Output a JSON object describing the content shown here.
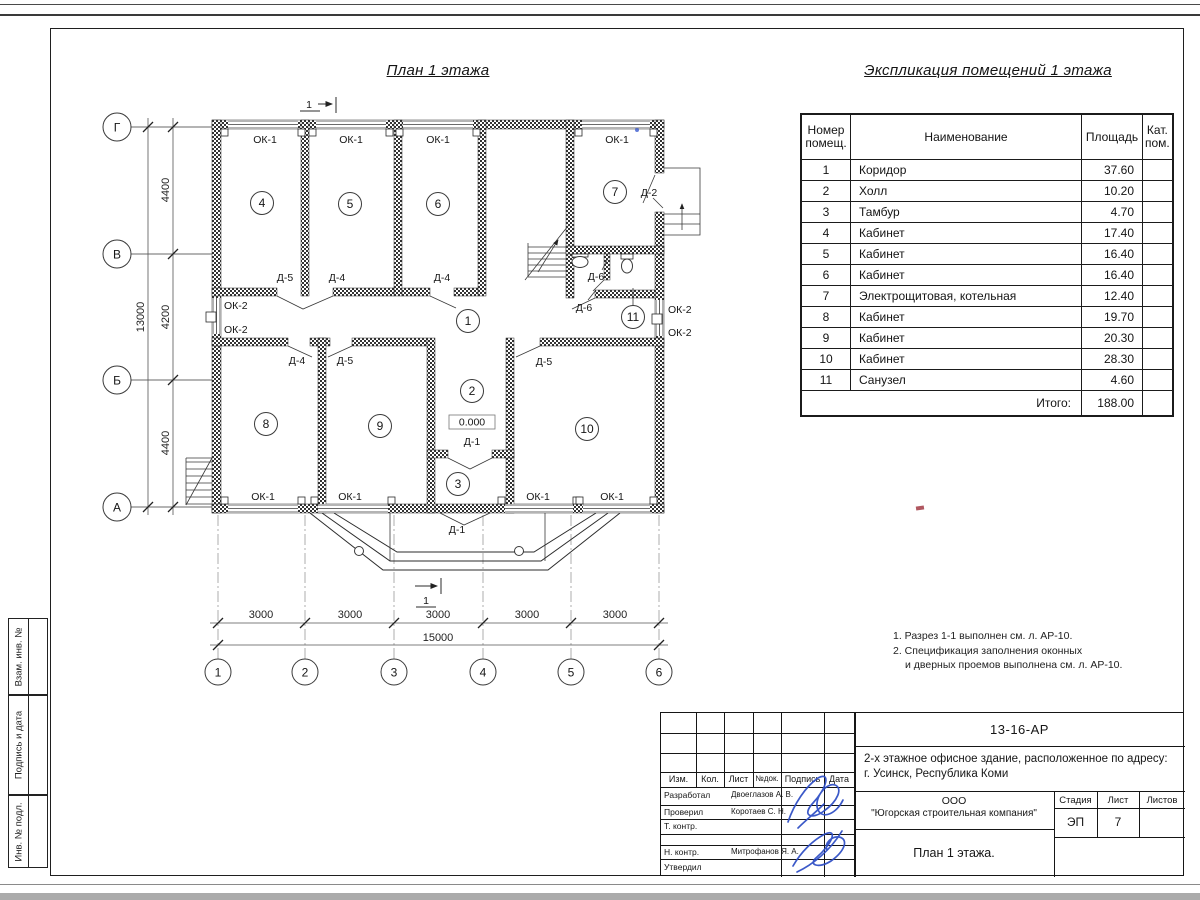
{
  "titles": {
    "plan": "План 1 этажа",
    "explication": "Экспликация помещений 1 этажа"
  },
  "explication": {
    "headers": {
      "number": "Номер",
      "number2": "помещ.",
      "name": "Наименование",
      "area": "Площадь",
      "cat": "Кат.",
      "cat2": "пом."
    },
    "rows": [
      {
        "num": "1",
        "name": "Коридор",
        "area": "37.60"
      },
      {
        "num": "2",
        "name": "Холл",
        "area": "10.20"
      },
      {
        "num": "3",
        "name": "Тамбур",
        "area": "4.70"
      },
      {
        "num": "4",
        "name": "Кабинет",
        "area": "17.40"
      },
      {
        "num": "5",
        "name": "Кабинет",
        "area": "16.40"
      },
      {
        "num": "6",
        "name": "Кабинет",
        "area": "16.40"
      },
      {
        "num": "7",
        "name": "Электрощитовая, котельная",
        "area": "12.40"
      },
      {
        "num": "8",
        "name": "Кабинет",
        "area": "19.70"
      },
      {
        "num": "9",
        "name": "Кабинет",
        "area": "20.30"
      },
      {
        "num": "10",
        "name": "Кабинет",
        "area": "28.30"
      },
      {
        "num": "11",
        "name": "Санузел",
        "area": "4.60"
      }
    ],
    "total_label": "Итого:",
    "total_value": "188.00"
  },
  "plan": {
    "labels": {
      "ok1": "ОК-1",
      "ok2": "ОК-2",
      "d1": "Д-1",
      "d2": "Д-2",
      "d4": "Д-4",
      "d5": "Д-5",
      "d6": "Д-6",
      "elevation": "0.000",
      "section": "1"
    },
    "rooms": [
      "1",
      "2",
      "3",
      "4",
      "5",
      "6",
      "7",
      "8",
      "9",
      "10",
      "11"
    ],
    "axes": {
      "vertical": [
        "Г",
        "В",
        "Б",
        "А"
      ],
      "horizontal": [
        "1",
        "2",
        "3",
        "4",
        "5",
        "6"
      ]
    },
    "dims": {
      "left": [
        "4400",
        "4200",
        "4400"
      ],
      "left_total": "13000",
      "bottom": [
        "3000",
        "3000",
        "3000",
        "3000",
        "3000"
      ],
      "bottom_total": "15000"
    }
  },
  "notes": [
    "1. Разрез 1-1 выполнен см. л. АР-10.",
    "2. Спецификация заполнения оконных",
    "и дверных проемов выполнена см. л. АР-10."
  ],
  "titleblock": {
    "doc_number": "13-16-АР",
    "object_line1": "2-х этажное офисное здание, расположенное по адресу:",
    "object_line2": "г. Усинск, Республика Коми",
    "columns": [
      "Изм.",
      "Кол.",
      "Лист",
      "№док.",
      "Подпись",
      "Дата"
    ],
    "roles": [
      {
        "role": "Разработал",
        "name": "Двоеглазов А. В."
      },
      {
        "role": "Проверил",
        "name": "Коротаев С. Н."
      },
      {
        "role": "Т. контр.",
        "name": ""
      },
      {
        "role": "Н. контр.",
        "name": "Митрофанов Я. А."
      },
      {
        "role": "Утвердил",
        "name": ""
      }
    ],
    "company_line1": "ООО",
    "company_line2": "\"Югорская строительная компания\"",
    "stage_label": "Стадия",
    "sheet_label": "Лист",
    "sheets_label": "Листов",
    "stage_value": "ЭП",
    "sheet_value": "7",
    "sheet_title": "План 1 этажа."
  },
  "sidebar": {
    "boxes": [
      "Взам. инв. №",
      "Подпись и дата",
      "Инв. № подл."
    ]
  }
}
